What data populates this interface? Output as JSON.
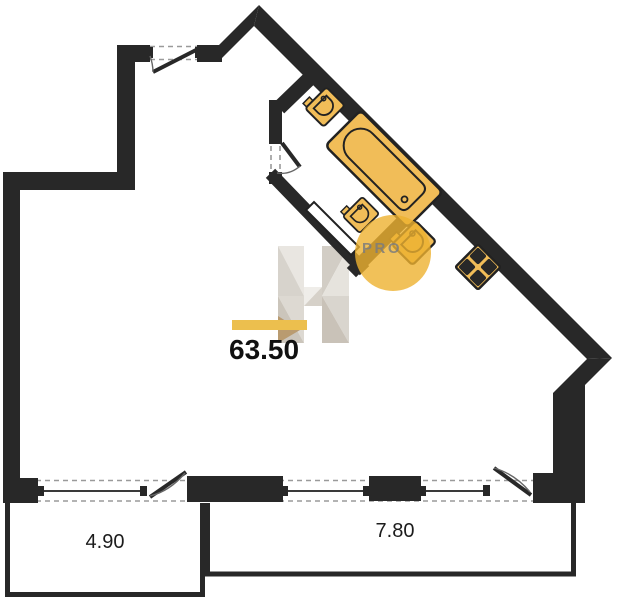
{
  "plan": {
    "title": "apartment-floor-plan",
    "area_label": "63.50",
    "dimensions": {
      "left_balcony": "4.90",
      "right_balcony": "7.80"
    },
    "watermark": {
      "letter": "H",
      "text": "PRO"
    },
    "fixtures": [
      {
        "name": "washbasin-top"
      },
      {
        "name": "bathtub"
      },
      {
        "name": "washbasin-small"
      },
      {
        "name": "kitchen-sink"
      },
      {
        "name": "stove-4-burner"
      }
    ],
    "colors": {
      "wall": "#282828",
      "fixture": "#f1bd58",
      "highlight": "#ecbf4e",
      "watermark_circle": "#eeb12f",
      "watermark_text": "#7d7d7d",
      "window_dash": "#9a9a9a",
      "glazing": "#3a3a3a",
      "background": "#ffffff"
    }
  }
}
